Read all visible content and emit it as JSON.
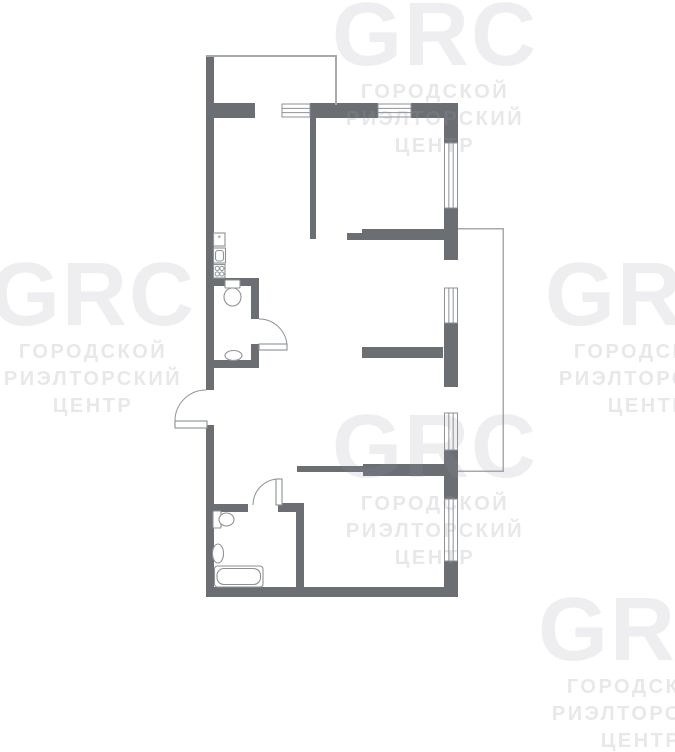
{
  "canvas": {
    "width": 675,
    "height": 662,
    "background": "#ffffff"
  },
  "colors": {
    "wall": "#6b6f74",
    "fixture_line": "#8d9297",
    "thin_line": "#a6a9ad",
    "floor": "#ffffff"
  },
  "watermark": {
    "logo": "GRC",
    "lines": [
      "ГОРОДСКОЙ",
      "РИЭЛТОРСКИЙ",
      "ЦЕНТР"
    ],
    "tiles": [
      {
        "cx": 435,
        "top": 6
      },
      {
        "cx": 93,
        "top": 266
      },
      {
        "cx": 648,
        "top": 266
      },
      {
        "cx": 435,
        "top": 418
      },
      {
        "cx": 641,
        "top": 601
      }
    ]
  },
  "floorplan": {
    "walls": [
      {
        "n": "exterior-wall-left-upper",
        "x": 206,
        "y": 55,
        "w": 8,
        "h": 335
      },
      {
        "n": "exterior-wall-left-lower",
        "x": 206,
        "y": 425,
        "w": 8,
        "h": 172
      },
      {
        "n": "exterior-wall-top-a",
        "x": 206,
        "y": 103,
        "w": 49,
        "h": 15
      },
      {
        "n": "exterior-wall-top-b",
        "x": 310,
        "y": 103,
        "w": 68,
        "h": 15
      },
      {
        "n": "exterior-wall-top-c",
        "x": 411,
        "y": 103,
        "w": 47,
        "h": 15
      },
      {
        "n": "exterior-wall-right-a",
        "x": 444,
        "y": 103,
        "w": 14,
        "h": 40
      },
      {
        "n": "exterior-wall-right-b",
        "x": 444,
        "y": 208,
        "w": 14,
        "h": 52
      },
      {
        "n": "exterior-wall-right-c",
        "x": 444,
        "y": 323,
        "w": 14,
        "h": 64
      },
      {
        "n": "exterior-wall-right-d",
        "x": 444,
        "y": 450,
        "w": 14,
        "h": 49
      },
      {
        "n": "exterior-wall-right-e",
        "x": 444,
        "y": 561,
        "w": 14,
        "h": 36
      },
      {
        "n": "exterior-wall-bottom",
        "x": 206,
        "y": 587,
        "w": 252,
        "h": 10
      },
      {
        "n": "interior-wall-kitchen",
        "x": 310,
        "y": 118,
        "w": 6,
        "h": 121
      },
      {
        "n": "interior-wall-a-thin",
        "x": 347,
        "y": 233,
        "w": 15,
        "h": 7
      },
      {
        "n": "interior-wall-a",
        "x": 362,
        "y": 229,
        "w": 82,
        "h": 11
      },
      {
        "n": "interior-wall-b",
        "x": 362,
        "y": 347,
        "w": 81,
        "h": 11
      },
      {
        "n": "interior-wall-c-thin",
        "x": 297,
        "y": 466,
        "w": 66,
        "h": 6
      },
      {
        "n": "interior-wall-c",
        "x": 363,
        "y": 464,
        "w": 81,
        "h": 12
      },
      {
        "n": "wc-wall-top",
        "x": 213,
        "y": 278,
        "w": 46,
        "h": 8
      },
      {
        "n": "wc-wall-right-upper",
        "x": 251,
        "y": 286,
        "w": 8,
        "h": 33
      },
      {
        "n": "wc-wall-right-lower",
        "x": 251,
        "y": 344,
        "w": 8,
        "h": 24
      },
      {
        "n": "wc-wall-bottom",
        "x": 206,
        "y": 360,
        "w": 53,
        "h": 8
      },
      {
        "n": "bathroom-wall-top-left",
        "x": 213,
        "y": 504,
        "w": 35,
        "h": 8
      },
      {
        "n": "bathroom-wall-top-right",
        "x": 278,
        "y": 503,
        "w": 26,
        "h": 9
      },
      {
        "n": "bathroom-wall-right",
        "x": 296,
        "y": 503,
        "w": 8,
        "h": 85
      }
    ],
    "thin_lines": [
      {
        "n": "upper-zone-line-top",
        "x": 206,
        "y": 55,
        "w": 131,
        "h": 2
      },
      {
        "n": "upper-zone-line-right",
        "x": 335,
        "y": 55,
        "w": 2,
        "h": 50
      },
      {
        "n": "balcony-line-top",
        "x": 458,
        "y": 228,
        "w": 46,
        "h": 1.5
      },
      {
        "n": "balcony-line-right",
        "x": 502.5,
        "y": 228,
        "w": 1.5,
        "h": 244
      },
      {
        "n": "balcony-line-bottom",
        "x": 458,
        "y": 470.5,
        "w": 46,
        "h": 1.5
      }
    ],
    "windows": [
      {
        "n": "window-top-1",
        "x": 282,
        "y": 104,
        "w": 28,
        "h": 13,
        "o": "h"
      },
      {
        "n": "window-top-2",
        "x": 378,
        "y": 104,
        "w": 33,
        "h": 13,
        "o": "h"
      },
      {
        "n": "window-right-1",
        "x": 444.5,
        "y": 143,
        "w": 13,
        "h": 65,
        "o": "v"
      },
      {
        "n": "window-right-2",
        "x": 444.5,
        "y": 288,
        "w": 13,
        "h": 35,
        "o": "v"
      },
      {
        "n": "window-right-3",
        "x": 444.5,
        "y": 413,
        "w": 13,
        "h": 37,
        "o": "v"
      },
      {
        "n": "window-right-4",
        "x": 444.5,
        "y": 499,
        "w": 13,
        "h": 62,
        "o": "v"
      }
    ],
    "doors": [
      {
        "n": "wc-door",
        "leaf": {
          "x": 259,
          "y": 344,
          "w": 28,
          "h": 6
        },
        "arc": "M 287 347 A 28 28 0 0 0 259 319"
      },
      {
        "n": "entrance-door",
        "leaf": {
          "x": 175,
          "y": 421,
          "w": 32,
          "h": 7
        },
        "arc": "M 175 421 A 31 31 0 0 1 206 390"
      },
      {
        "n": "bathroom-door",
        "leaf": {
          "x": 276,
          "y": 479,
          "w": 6,
          "h": 26
        },
        "arc": "M 253 505 A 26 26 0 0 1 279 479"
      }
    ],
    "fixtures": [
      {
        "n": "kitchen-vent-box-icon",
        "t": "rect",
        "x": 213.5,
        "y": 233,
        "w": 11.5,
        "h": 13
      },
      {
        "n": "kitchen-vent-glyph",
        "t": "text",
        "x": 219.3,
        "y": 241.5,
        "s": "*"
      },
      {
        "n": "kitchen-sink-box-icon",
        "t": "rect",
        "x": 213.5,
        "y": 248,
        "w": 12,
        "h": 15
      },
      {
        "n": "kitchen-sink-inner-icon",
        "t": "rect",
        "x": 215.5,
        "y": 250.5,
        "w": 8,
        "h": 10.5,
        "r": 2.5
      },
      {
        "n": "kitchen-stove-box-icon",
        "t": "rect",
        "x": 213.5,
        "y": 264.5,
        "w": 11.5,
        "h": 13.5
      },
      {
        "n": "stove-burner-icon",
        "t": "circle",
        "cx": 217.2,
        "cy": 268.4,
        "r": 2.1
      },
      {
        "n": "stove-burner-icon",
        "t": "circle",
        "cx": 221.9,
        "cy": 268.4,
        "r": 2.1
      },
      {
        "n": "stove-burner-icon",
        "t": "circle",
        "cx": 217.2,
        "cy": 274,
        "r": 2.1
      },
      {
        "n": "stove-burner-icon",
        "t": "circle",
        "cx": 221.9,
        "cy": 274,
        "r": 2.1
      },
      {
        "n": "wc-toilet-tank-icon",
        "t": "rect",
        "x": 225,
        "y": 280,
        "w": 15,
        "h": 8,
        "r": 1
      },
      {
        "n": "wc-toilet-bowl-icon",
        "t": "ellipse",
        "cx": 232.5,
        "cy": 297,
        "rx": 8.5,
        "ry": 9
      },
      {
        "n": "wc-sink-icon",
        "t": "ellipse",
        "cx": 233.5,
        "cy": 355.5,
        "rx": 8.5,
        "ry": 5
      },
      {
        "n": "bath-toilet-tank-icon",
        "t": "rect",
        "x": 213,
        "y": 511,
        "w": 8,
        "h": 17,
        "r": 1
      },
      {
        "n": "bath-toilet-bowl-icon",
        "t": "ellipse",
        "cx": 226.5,
        "cy": 519.5,
        "rx": 7.5,
        "ry": 6.5
      },
      {
        "n": "bath-sink-icon",
        "t": "ellipse",
        "cx": 218,
        "cy": 553.5,
        "rx": 5.5,
        "ry": 9.5
      },
      {
        "n": "bathtub-outer-icon",
        "t": "rect",
        "x": 214.5,
        "y": 566,
        "w": 48.5,
        "h": 21,
        "r": 3
      },
      {
        "n": "bathtub-inner-icon",
        "t": "rect",
        "x": 217,
        "y": 568.5,
        "w": 43.5,
        "h": 16,
        "r": 7
      }
    ]
  }
}
